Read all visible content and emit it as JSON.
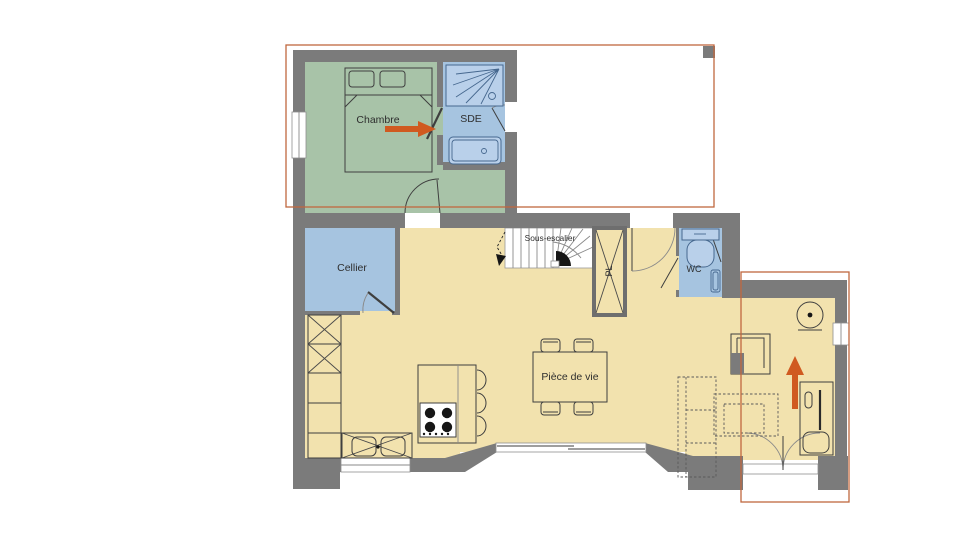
{
  "plan": {
    "title": "floor-plan",
    "rooms": {
      "chambre": {
        "label": "Chambre"
      },
      "sde": {
        "label": "SDE"
      },
      "cellier": {
        "label": "Cellier"
      },
      "wc": {
        "label": "WC"
      },
      "piece_de_vie": {
        "label": "Pièce de vie"
      },
      "sous_escalier": {
        "label": "Sous-escalier"
      },
      "placard": {
        "label": "PL"
      }
    },
    "colors": {
      "wall": "#7b7b7b",
      "bedroom_floor": "#a8c3a8",
      "wet_room_floor": "#a6c4e0",
      "living_floor": "#f2e2ae",
      "fixture_fill": "#b9d0ea",
      "fixture_line": "#46688f",
      "outline": "#3f3f3f",
      "plan_overlay": "#c0683f",
      "arrow": "#d05a20"
    }
  }
}
